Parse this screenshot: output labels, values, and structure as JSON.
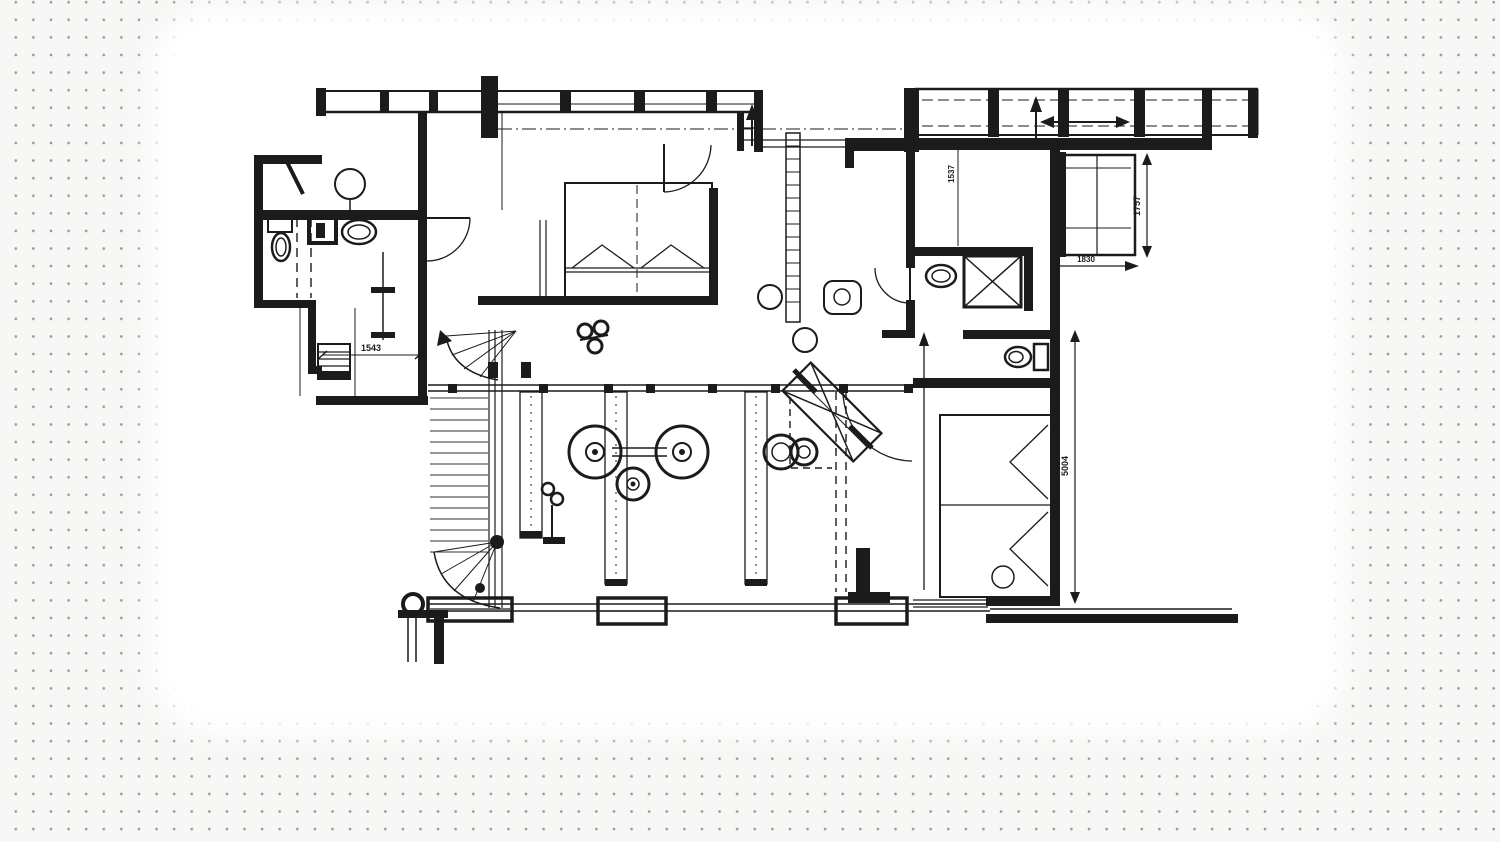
{
  "scene": {
    "type": "architectural floor plan drawing on dotted canvas",
    "background": {
      "base_color": "#f7f7f5",
      "dot_color": "#9b9b9b",
      "paper_color": "#ffffff"
    },
    "ink_color": "#1b1b1b"
  },
  "dimensions": {
    "left_wing": "1543",
    "entry_depth": "1537",
    "balcony_height": "1757",
    "balcony_width": "1830",
    "right_wing": "5004"
  },
  "symbols": [
    "straight-stair",
    "winder-stair",
    "double-bed",
    "toilet",
    "wash-basin",
    "shower",
    "column-marker",
    "direction-arrow",
    "sliding-arrow",
    "wardrobe",
    "radiator",
    "door-swing"
  ]
}
